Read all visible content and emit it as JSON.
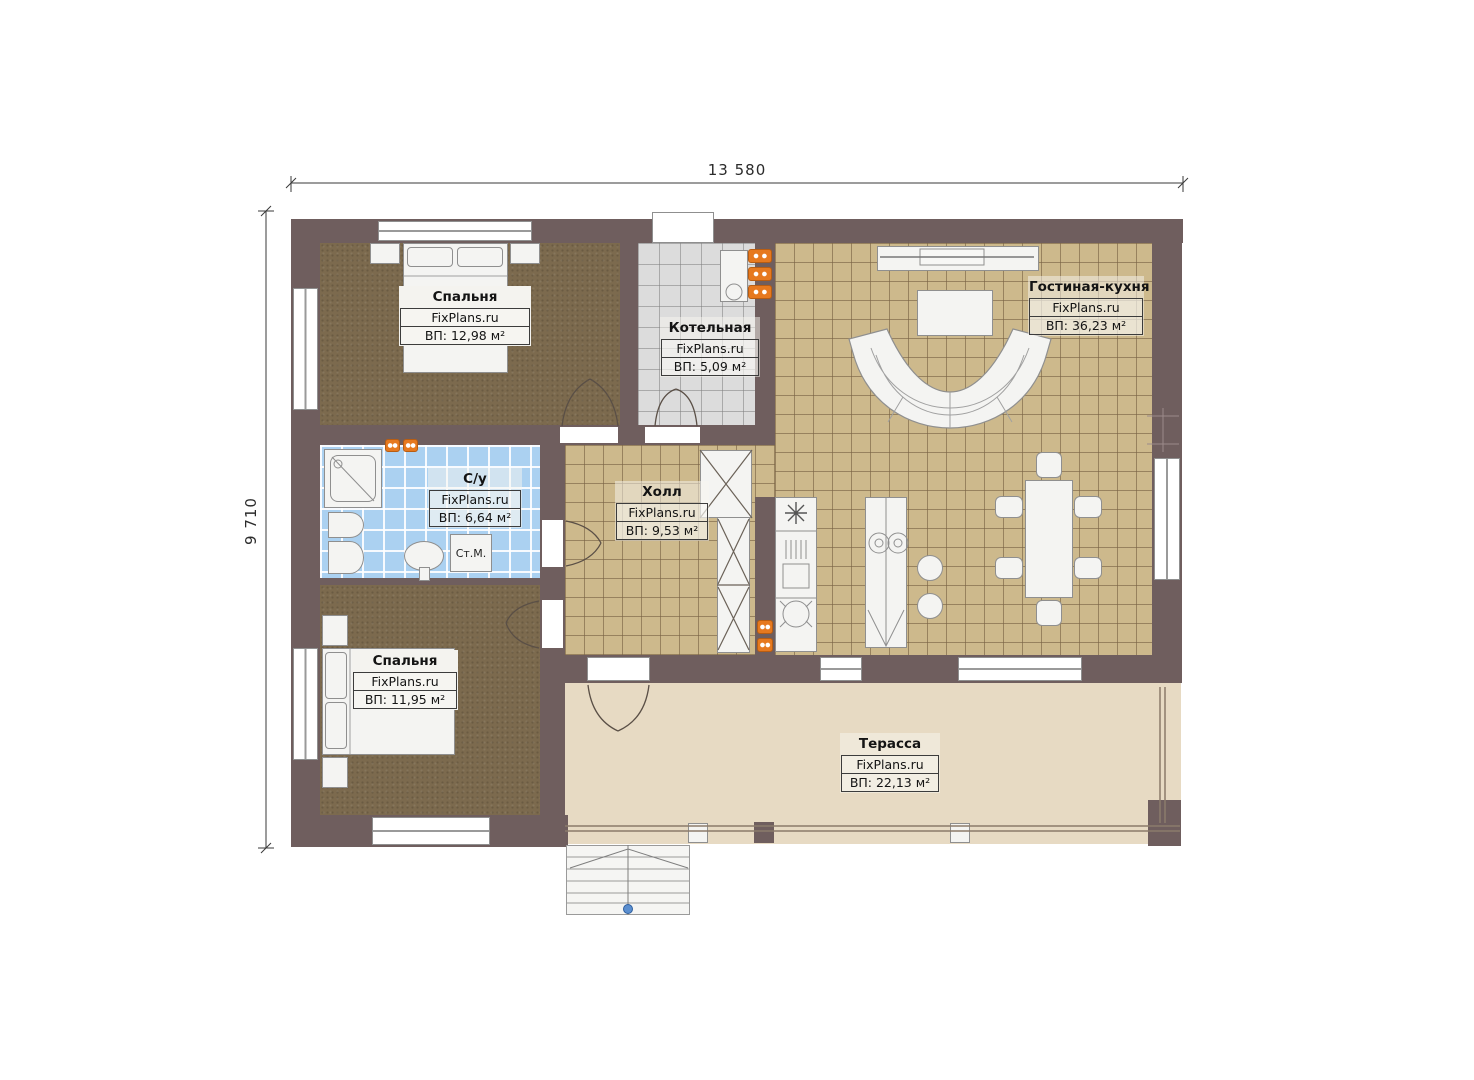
{
  "meta": {
    "brand": "FixPlans.ru"
  },
  "dimensions": {
    "width_label": "13 580",
    "height_label": "9 710"
  },
  "rooms": [
    {
      "id": "bedroom-1",
      "name": "Спальня",
      "area": "ВП: 12,98 м²"
    },
    {
      "id": "boiler-room",
      "name": "Котельная",
      "area": "ВП: 5,09 м²"
    },
    {
      "id": "living-kitchen",
      "name": "Гостиная-кухня",
      "area": "ВП: 36,23 м²"
    },
    {
      "id": "bathroom",
      "name": "С/у",
      "area": "ВП: 6,64 м²"
    },
    {
      "id": "hall",
      "name": "Холл",
      "area": "ВП: 9,53 м²"
    },
    {
      "id": "bedroom-2",
      "name": "Спальня",
      "area": "ВП: 11,95 м²"
    },
    {
      "id": "terrace",
      "name": "Терасса",
      "area": "ВП: 22,13 м²"
    }
  ],
  "annotations": {
    "washing_machine": "Ст.М."
  },
  "colors": {
    "wall": "#6F5E5E",
    "carpet": "#7C6A4E",
    "tile_tan": "#CDB98C",
    "tile_gray": "#DCDCDC",
    "tile_blue": "#ABD1F1",
    "terrace": "#E7DAC3",
    "radiator": "#E6791F",
    "stair_point": "#5B8FD0"
  }
}
